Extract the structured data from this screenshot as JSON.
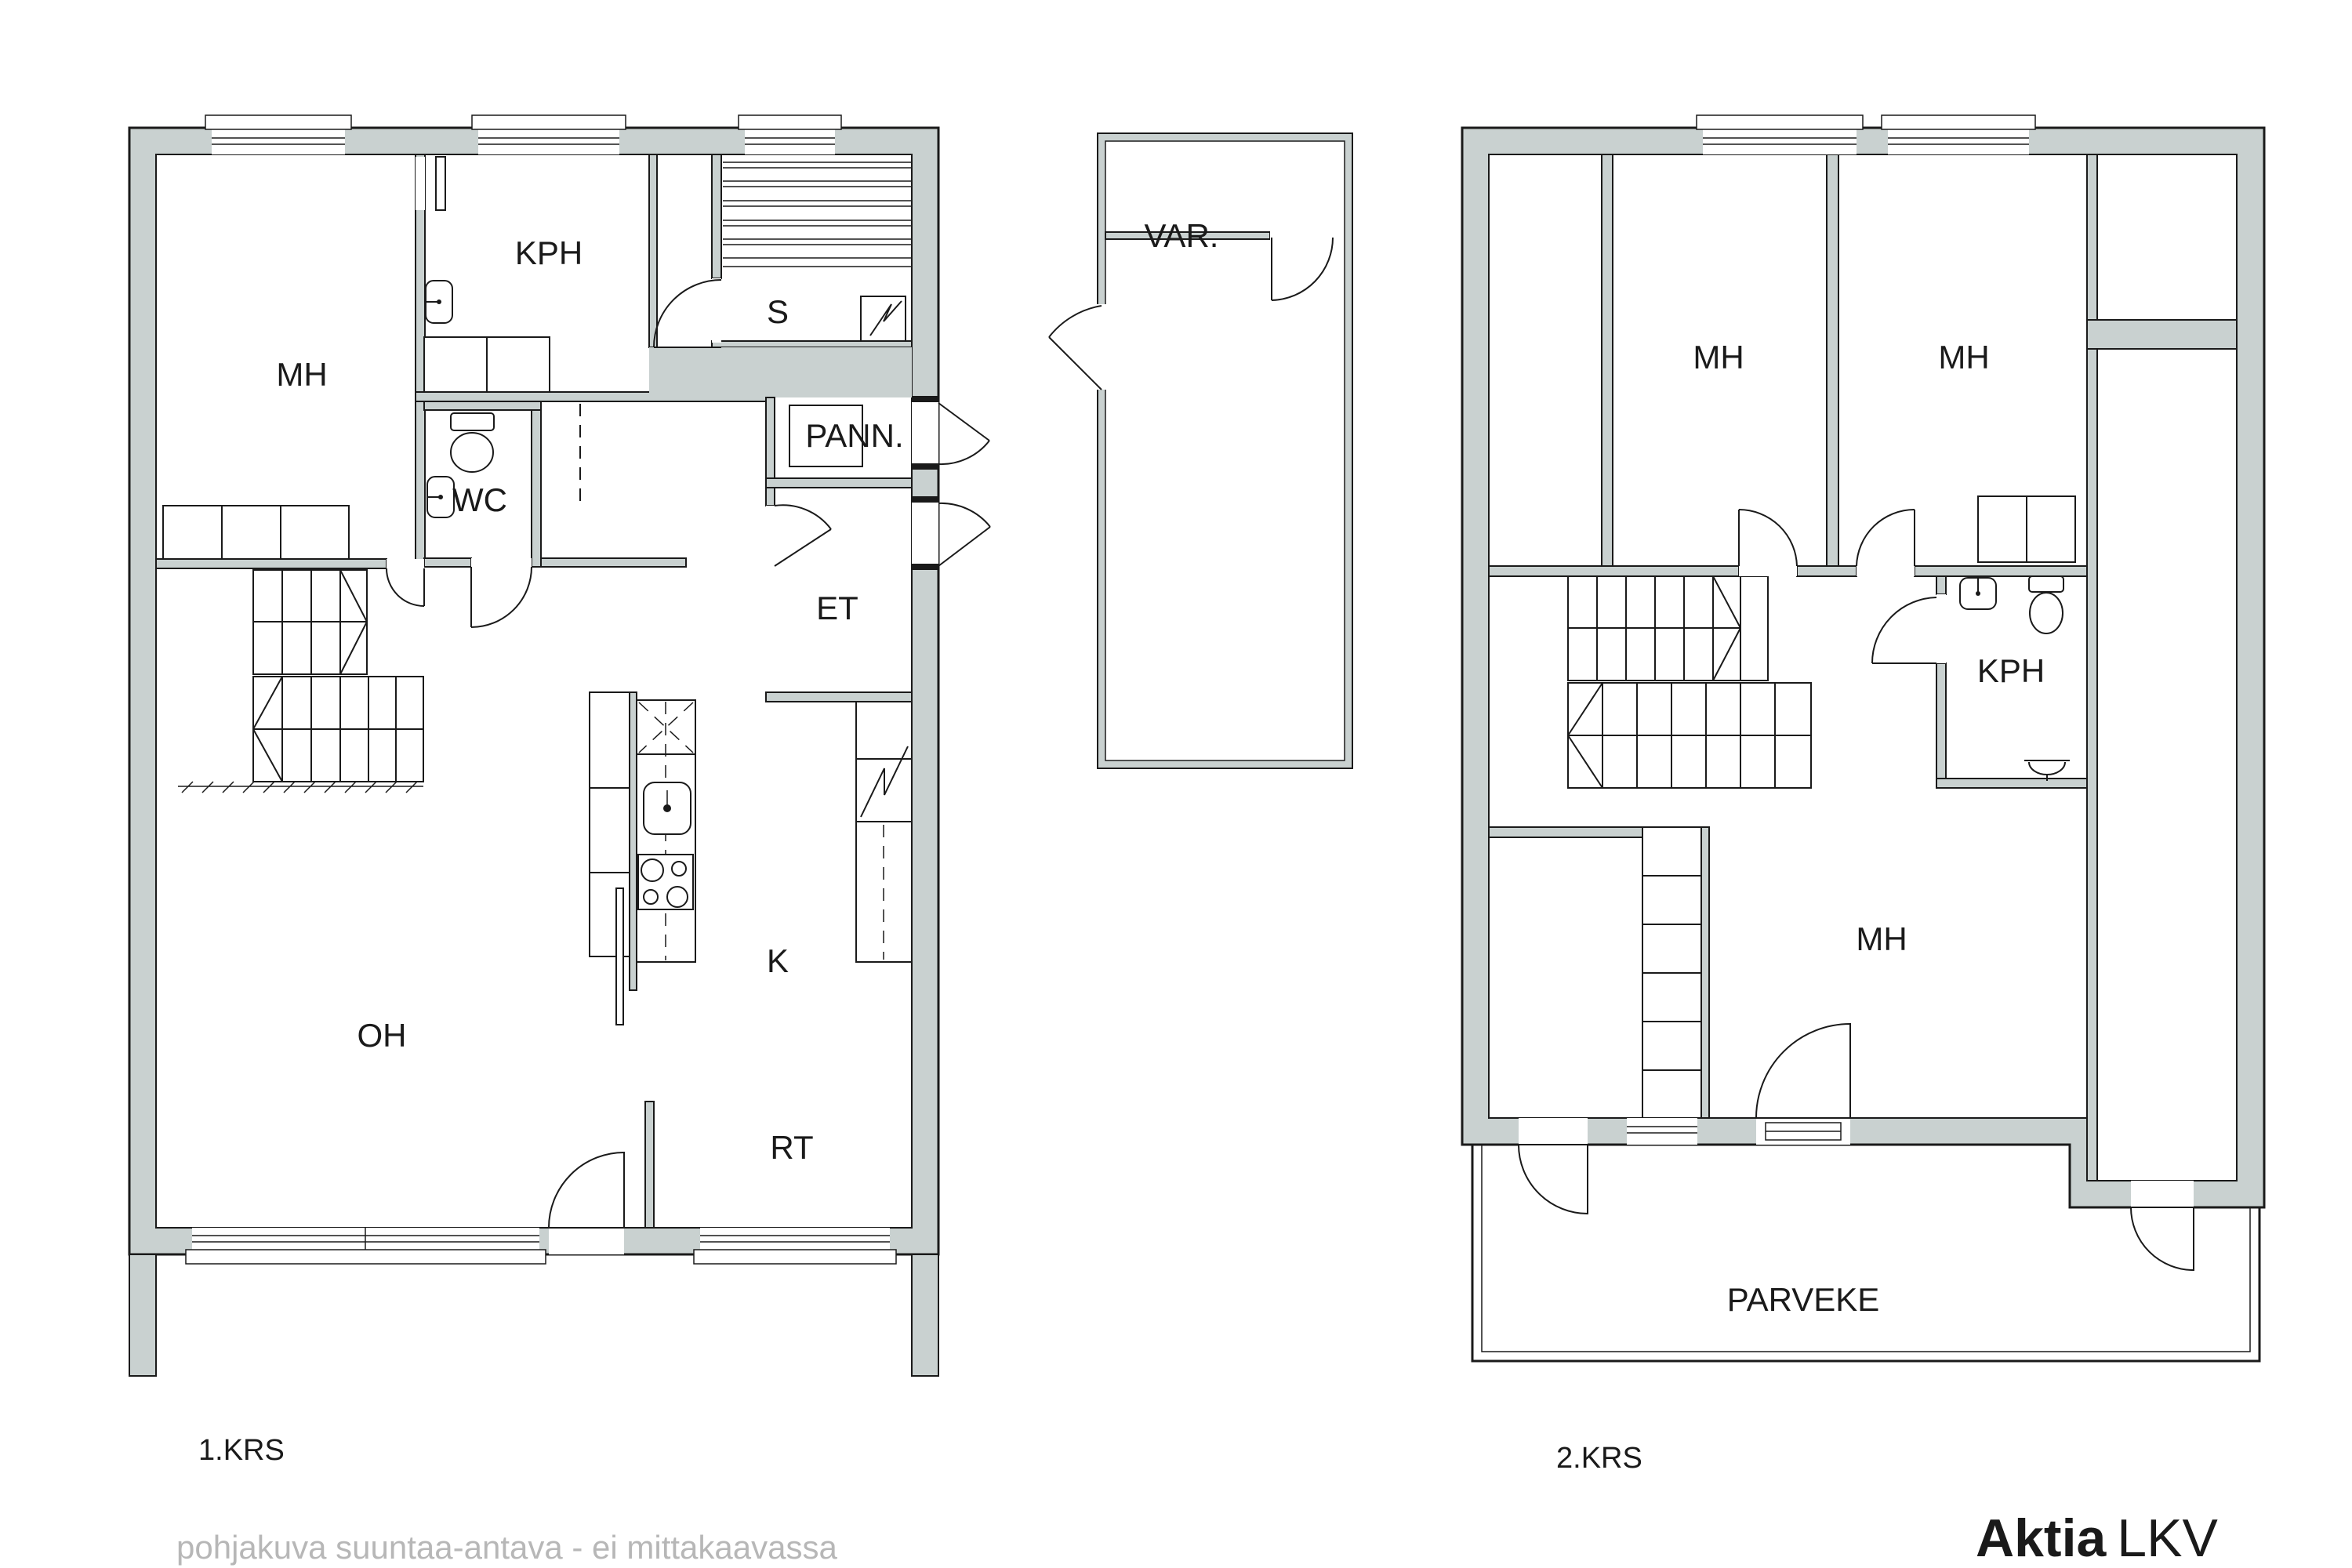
{
  "floor1": {
    "label": "1.KRS",
    "rooms": {
      "mh": "MH",
      "kph": "KPH",
      "s": "S",
      "pann": "PANN.",
      "wc": "WC",
      "et": "ET",
      "k": "K",
      "oh": "OH",
      "rt": "RT"
    }
  },
  "annex": {
    "var": "VAR."
  },
  "floor2": {
    "label": "2.KRS",
    "rooms": {
      "mh_top_left": "MH",
      "mh_top_right": "MH",
      "kph": "KPH",
      "mh_lower": "MH",
      "parveke": "PARVEKE"
    }
  },
  "footer": {
    "disclaimer": "pohjakuva suuntaa-antava - ei mittakaavassa",
    "brand_bold": "Aktia",
    "brand_light": "LKV"
  },
  "colors": {
    "wall": "#c9d1d0",
    "line": "#1a1a1a",
    "muted": "#b7b7b7",
    "bg": "#ffffff"
  }
}
